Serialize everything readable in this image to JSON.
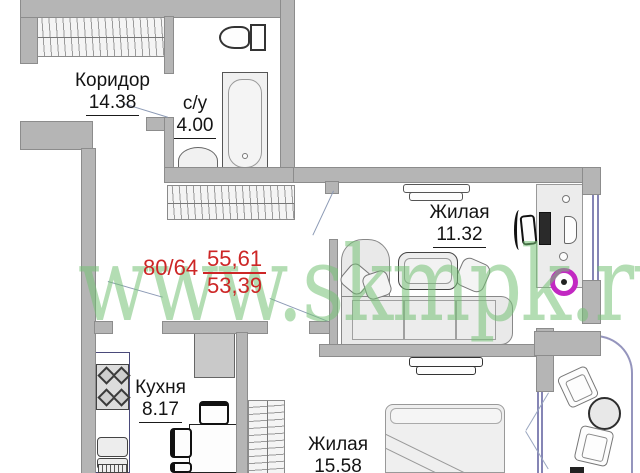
{
  "watermark": "www.skmpk.ru",
  "summary": {
    "rooms_ratio": "80/64",
    "total_area": "55,61",
    "living_area": "53,39"
  },
  "rooms": {
    "corridor": {
      "name": "Коридор",
      "area": "14.38"
    },
    "bathroom": {
      "name": "с/у",
      "area": "4.00"
    },
    "living_room": {
      "name": "Жилая",
      "area": "11.32"
    },
    "kitchen": {
      "name": "Кухня",
      "area": "8.17"
    },
    "bedroom": {
      "name": "Жилая",
      "area": "15.58"
    }
  },
  "colors": {
    "wall": "#b5b5b5",
    "area_text": "#cd2626",
    "watermark": "#75c175",
    "window_frame": "#8585b5",
    "wheel_accent": "#c228c2"
  }
}
